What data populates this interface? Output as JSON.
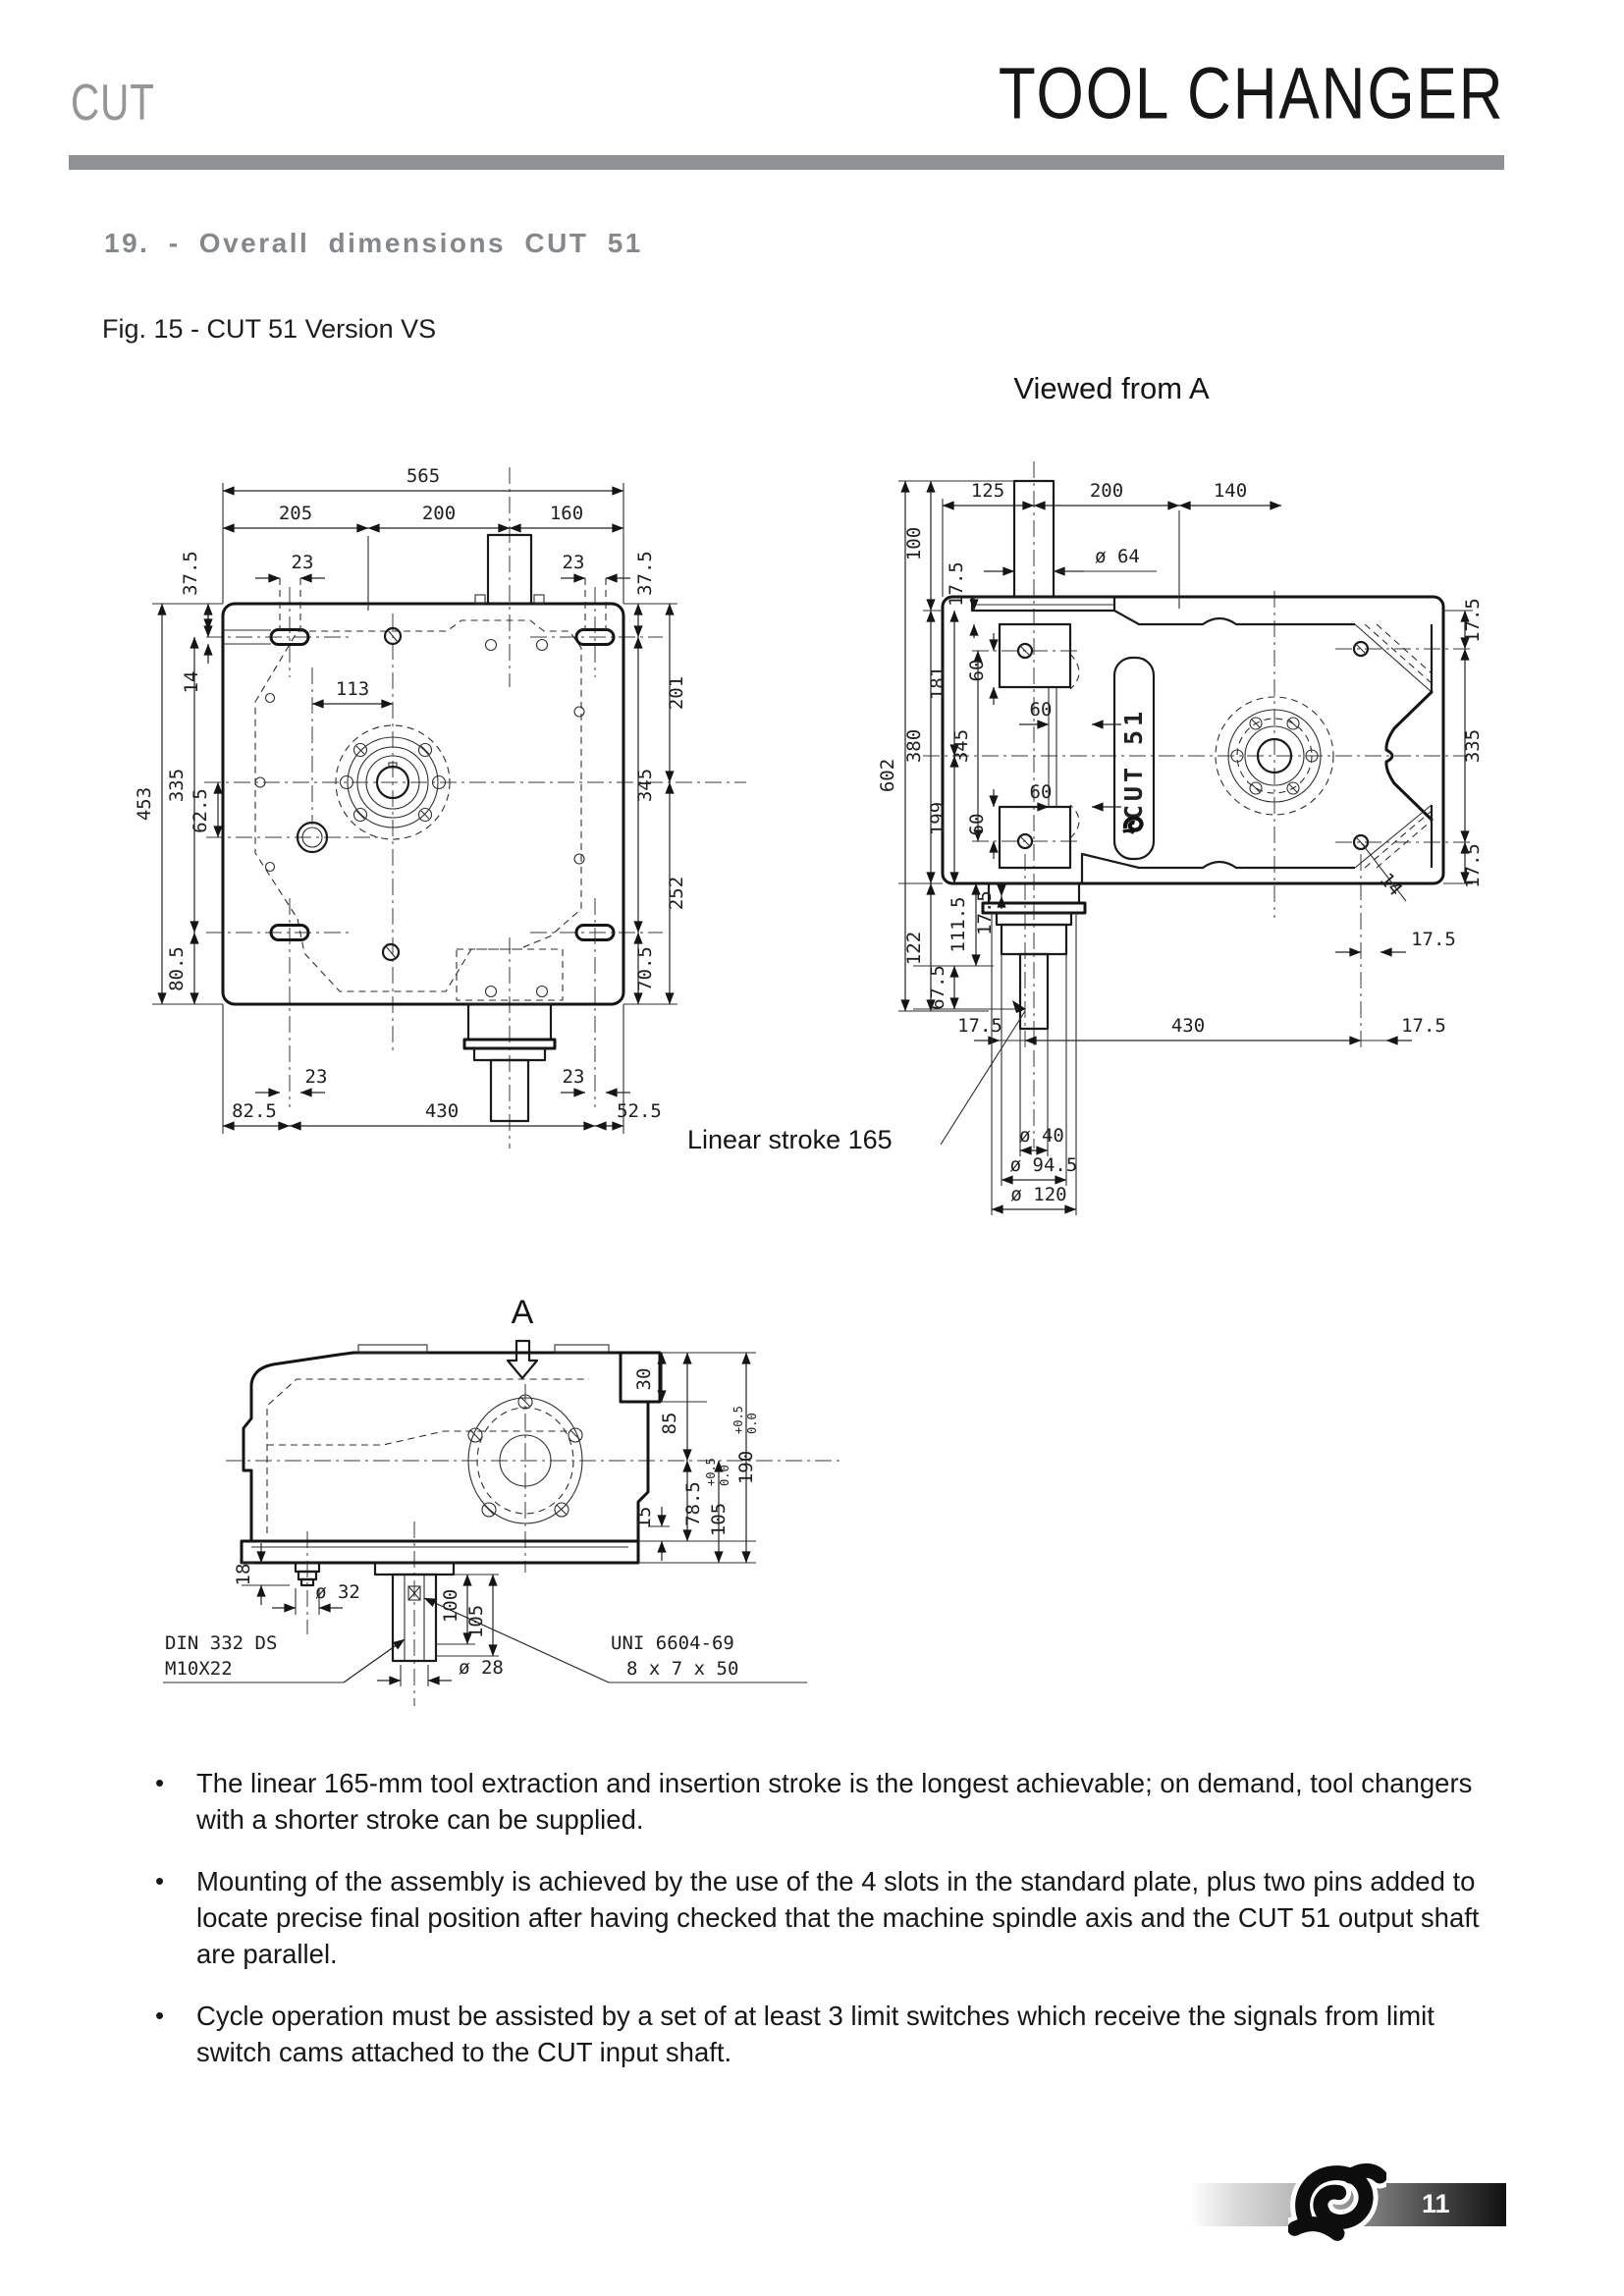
{
  "header": {
    "brand": "CUT",
    "title": "TOOL CHANGER"
  },
  "section": {
    "heading": "19. - Overall dimensions  CUT 51"
  },
  "figure": {
    "caption": "Fig. 15 - CUT 51  Version VS",
    "viewed_from": "Viewed from  A",
    "arrow_label": "A",
    "nameplate": "CUT 51",
    "stroke_note": "Linear stroke 165"
  },
  "plan": {
    "overall_width": "565",
    "seg_left": "205",
    "seg_mid": "200",
    "seg_right": "160",
    "slot_pitch": "23",
    "edge_top": "37.5",
    "slot_width": "14",
    "overall_height": "453",
    "slots_span_v": "335",
    "pin_offset": "62.5",
    "edge_bottom": "80.5",
    "flange_offset": "113",
    "right_upper": "201",
    "right_span": "345",
    "right_lower": "252",
    "right_edge_bottom": "70.5",
    "bottom_left": "82.5",
    "bottom_span": "430",
    "bottom_right": "52.5"
  },
  "front": {
    "seg_left": "125",
    "seg_mid": "200",
    "seg_right": "140",
    "shaft_dia": "ø 64",
    "shaft_h": "100",
    "total_h": "602",
    "body_h": "380",
    "upper": "181",
    "lower": "199",
    "holes_span": "345",
    "bottom_h": "122",
    "bottom_inner": "111.5",
    "stroke_h": "67.5",
    "edge": "17.5",
    "slot": "60",
    "right_span": "335",
    "bottom_span": "430",
    "pin_dia": "14",
    "out_dia1": "ø 40",
    "out_dia2": "ø 94.5",
    "out_dia3": "ø 120"
  },
  "side": {
    "block": "30",
    "upper": "85",
    "step": "15",
    "lower": "78.5",
    "plate": "105",
    "total": "190",
    "tol_hi": "+0.5",
    "tol_lo": "0.0",
    "stud": "18",
    "stud_dia": "ø 32",
    "key_len": "100",
    "shaft_len": "105",
    "shaft_dia": "ø 28",
    "center_std1": "DIN 332 DS",
    "center_std2": "M10X22",
    "key_std1": "UNI 6604-69",
    "key_std2": "8 x 7 x 50"
  },
  "bullets": [
    "The linear 165-mm tool extraction and insertion stroke is the longest achievable; on demand, tool changers with a shorter stroke can be supplied.",
    "Mounting of the assembly is achieved by the use of the 4 slots in the standard plate, plus two pins added to locate precise final position after having checked that the machine spindle axis and the CUT 51 output shaft are parallel.",
    "Cycle operation must be assisted by a set of at least 3 limit switches which receive the signals from limit switch cams attached to the CUT input shaft."
  ],
  "footer": {
    "page": "11"
  }
}
